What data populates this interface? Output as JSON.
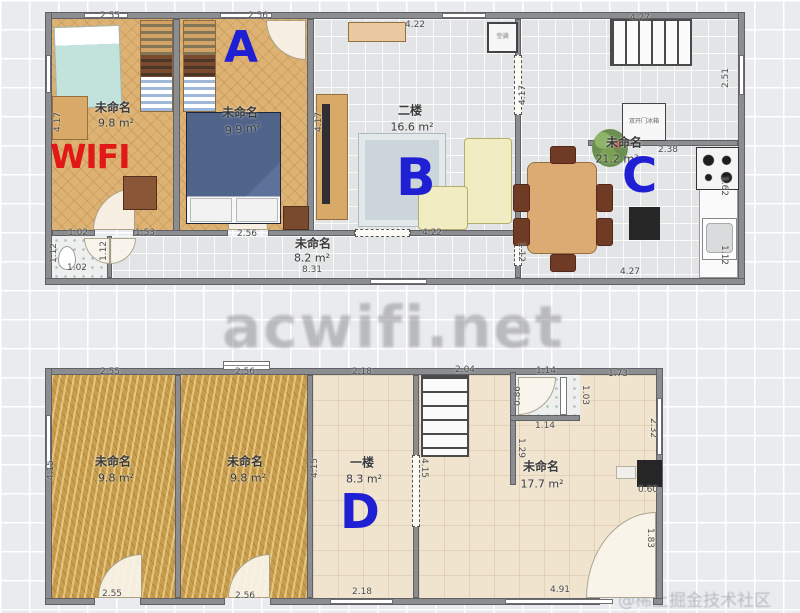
{
  "watermarks": {
    "center": "acwifi.net",
    "corner": "@稀土掘金技术社区"
  },
  "upper_floor": {
    "rooms": {
      "bedroom_left": {
        "name": "未命名",
        "area": "9.8 m²",
        "wifi": "WIFI"
      },
      "bedroom_a": {
        "name": "未命名",
        "area": "9.9 m²",
        "marker": "A"
      },
      "living": {
        "name": "二楼",
        "area": "16.6 m²",
        "marker": "B"
      },
      "kitchen": {
        "name": "未命名",
        "area": "21.2 m²",
        "marker": "C",
        "fridge": "双开门冰箱",
        "ac": "空调"
      },
      "corridor": {
        "name": "未命名",
        "area": "8.2 m²"
      }
    },
    "dims": {
      "top_bedroom_left": "2.55",
      "top_bedroom_a": "2.56",
      "top_living": "4.22",
      "top_kitchen": "4.27",
      "right_kitchen": "2.51",
      "fridge_wall": "2.38",
      "right_stove": "1.62",
      "right_sink": "1.12",
      "bottom_kitchen": "4.27",
      "corridor_toilet": "1.02",
      "corridor_seg1": "1.53",
      "corridor_seg2": "2.56",
      "corridor_seg3": "4.22",
      "corridor_total": "8.31",
      "toilet_bottom": "1.02",
      "toilet_left": "1.12",
      "toilet_right": "1.12",
      "left_wall": "4.17",
      "living_left": "4.17",
      "living_right": "4.17",
      "corridor_right": "1.12"
    }
  },
  "lower_floor": {
    "rooms": {
      "bedroom_left": {
        "name": "未命名",
        "area": "9.8 m²"
      },
      "bedroom_right": {
        "name": "未命名",
        "area": "9.8 m²"
      },
      "room_d": {
        "name": "一楼",
        "area": "8.3 m²",
        "marker": "D"
      },
      "main": {
        "name": "未命名",
        "area": "17.7 m²"
      }
    },
    "dims": {
      "top_bedroom_left": "2.55",
      "top_bedroom_right": "2.56",
      "top_d": "2.18",
      "top_stairs": "2.04",
      "top_shower": "1.14",
      "top_right": "1.73",
      "shower_left": "0.86",
      "shower_right": "1.03",
      "shower_bottom": "1.14",
      "below_shower": "1.29",
      "right_window": "2.32",
      "appliance": "0.60",
      "right_door": "1.83",
      "bottom_bedroom_left": "2.55",
      "bottom_bedroom_right": "2.56",
      "bottom_d": "2.18",
      "bottom_right": "4.91",
      "d_left": "4.15",
      "d_right": "4.15",
      "left_wall": "4.15"
    }
  },
  "colors": {
    "marker_blue": "#1f1fd4",
    "wifi_red": "#e01818",
    "watermark_gray": "#8b8b8e",
    "corner_gray": "#b5bac4"
  }
}
